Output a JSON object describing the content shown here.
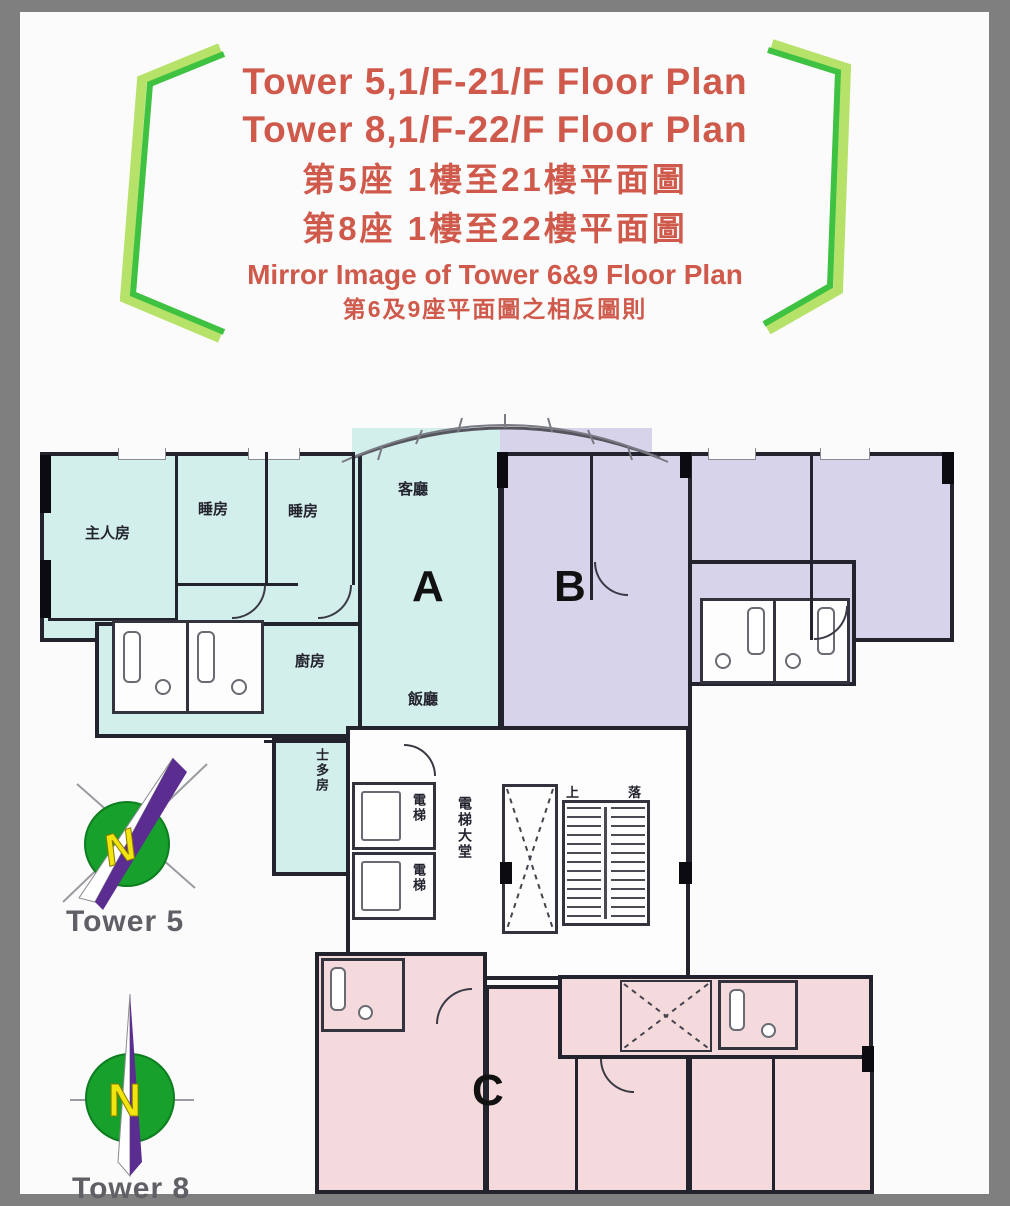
{
  "title": {
    "line1": "Tower 5,1/F-21/F Floor Plan",
    "line2": "Tower 8,1/F-22/F Floor Plan",
    "line3": "第5座  1樓至21樓平面圖",
    "line4": "第8座  1樓至22樓平面圖",
    "line5": "Mirror Image of Tower 6&9 Floor Plan",
    "line6": "第6及9座平面圖之相反圖則"
  },
  "units": {
    "a": "A",
    "b": "B",
    "c": "C"
  },
  "rooms": {
    "master_bedroom": "主人房",
    "bedroom": "睡房",
    "living_room": "客廳",
    "kitchen": "廚房",
    "dining_room": "飯廳",
    "store_room": "士多房",
    "lift": "電梯",
    "lift_lobby": "電梯大堂",
    "stairs_up": "上",
    "stairs_down": "落"
  },
  "compass": {
    "tower5_label": "Tower 5",
    "tower8_label": "Tower 8",
    "north_letter": "N"
  },
  "colors": {
    "frame_gray": "#7f7f7f",
    "title_text": "#cf5a4b",
    "bracket_green": "#3fc141",
    "bracket_light": "#b7e26a",
    "wall": "#23232e",
    "unit_a": "#d3efeb",
    "unit_b": "#d7d3ea",
    "unit_c": "#f4dadc",
    "compass_green": "#17a02b",
    "compass_yellow": "#f2e40e",
    "compass_purple": "#5c2d91"
  }
}
